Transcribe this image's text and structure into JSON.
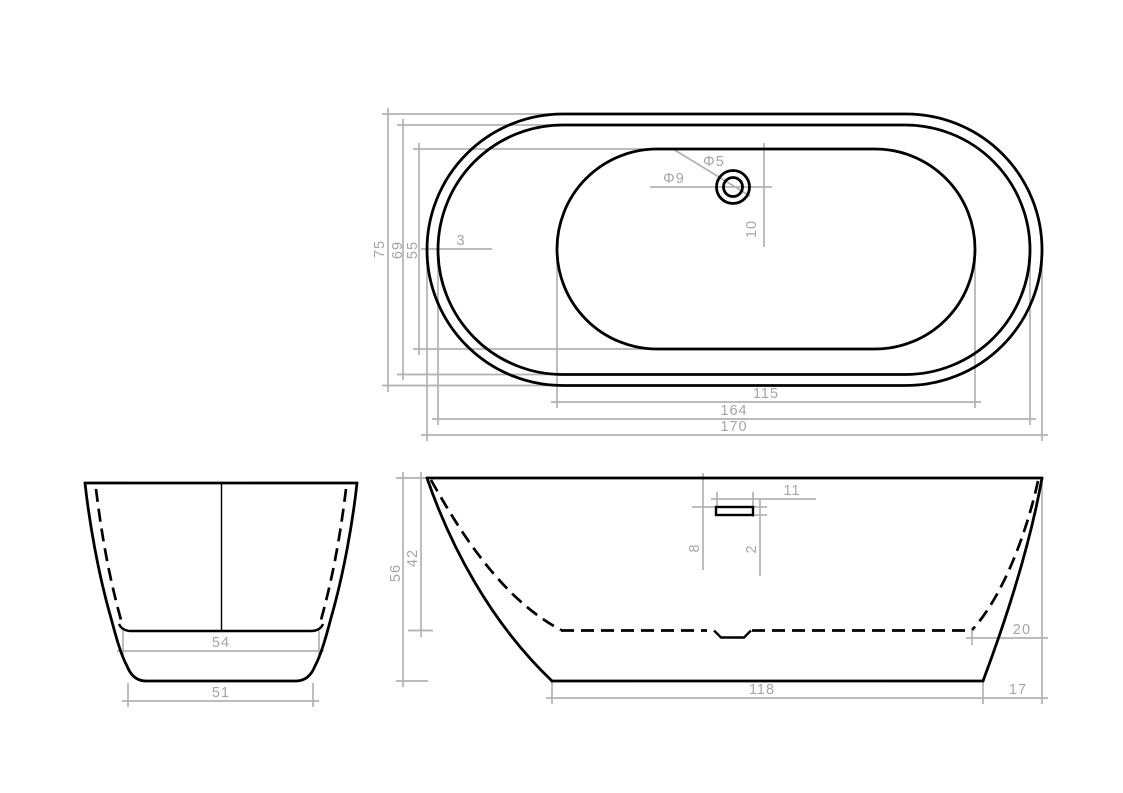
{
  "drawing": {
    "type": "bathtub-technical-drawing",
    "views": {
      "top_view": {
        "name": "plan view",
        "dims": {
          "overall_width": "75",
          "rim_inner_width": "69",
          "basin_width": "55",
          "rim_wall_thickness": "3",
          "drain_inner_diameter": "Φ5",
          "drain_outer_diameter": "Φ9",
          "drain_offset_from_basin_edge": "10",
          "basin_length": "115",
          "rim_inner_length": "164",
          "overall_length": "170"
        }
      },
      "end_view": {
        "name": "end elevation",
        "dims": {
          "inner_base_width": "54",
          "outer_base_width": "51"
        }
      },
      "side_view": {
        "name": "side elevation",
        "dims": {
          "overall_height": "56",
          "inner_depth": "42",
          "overflow_slot_length": "11",
          "overflow_top_offset": "8",
          "overflow_slot_height": "2",
          "inner_base_end_offset": "20",
          "base_length": "118",
          "base_end_offset": "17"
        }
      }
    },
    "colors": {
      "outline": "#000000",
      "dimension": "#b2b2b2",
      "background": "#ffffff"
    }
  }
}
